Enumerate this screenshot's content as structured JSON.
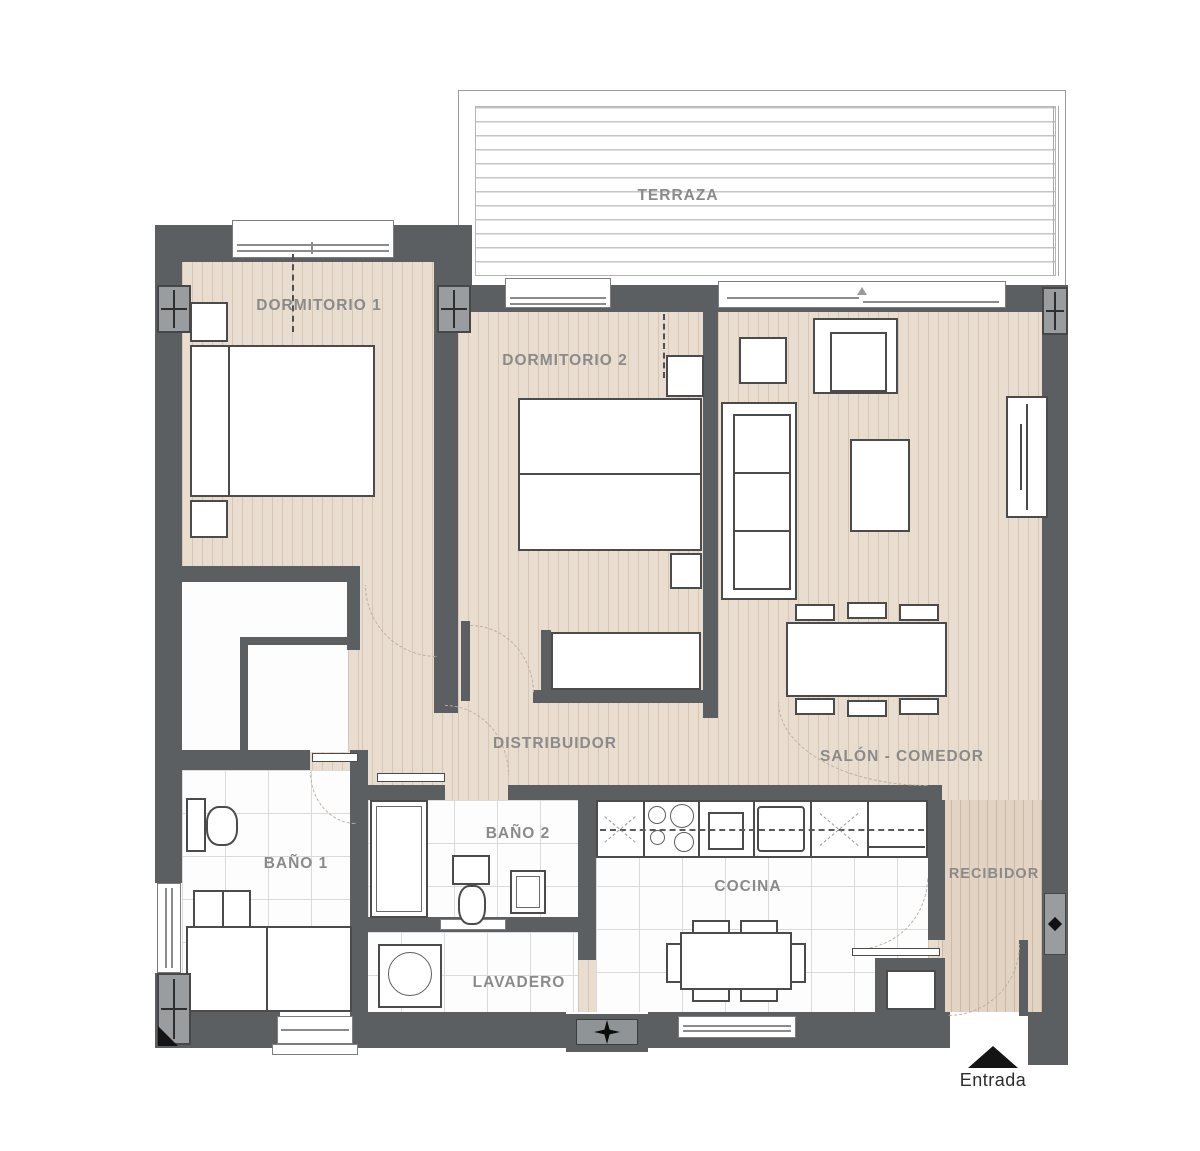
{
  "plan": {
    "rooms": [
      {
        "id": "terraza",
        "label": "TERRAZA"
      },
      {
        "id": "dormitorio-1",
        "label": "DORMITORIO 1"
      },
      {
        "id": "dormitorio-2",
        "label": "DORMITORIO 2"
      },
      {
        "id": "distribuidor",
        "label": "DISTRIBUIDOR"
      },
      {
        "id": "salon-comedor",
        "label": "SALÓN - COMEDOR"
      },
      {
        "id": "bano-1",
        "label": "BAÑO 1"
      },
      {
        "id": "bano-2",
        "label": "BAÑO 2"
      },
      {
        "id": "cocina",
        "label": "COCINA"
      },
      {
        "id": "lavadero",
        "label": "LAVADERO"
      },
      {
        "id": "recibidor",
        "label": "RECIBIDOR"
      }
    ],
    "entrance": {
      "label": "Entrada"
    },
    "colors": {
      "wall": "#5c5f61",
      "wood_floor": "#e9ddcf",
      "recibidor_floor": "#e2d3c3",
      "tile_line": "#dadada",
      "terrace_line": "#c6c6c6",
      "label_text": "#8a8a8a",
      "column_fill": "#999d9f",
      "furniture_stroke": "#4b4b4b",
      "entrance_text": "#2c2c2c"
    }
  }
}
